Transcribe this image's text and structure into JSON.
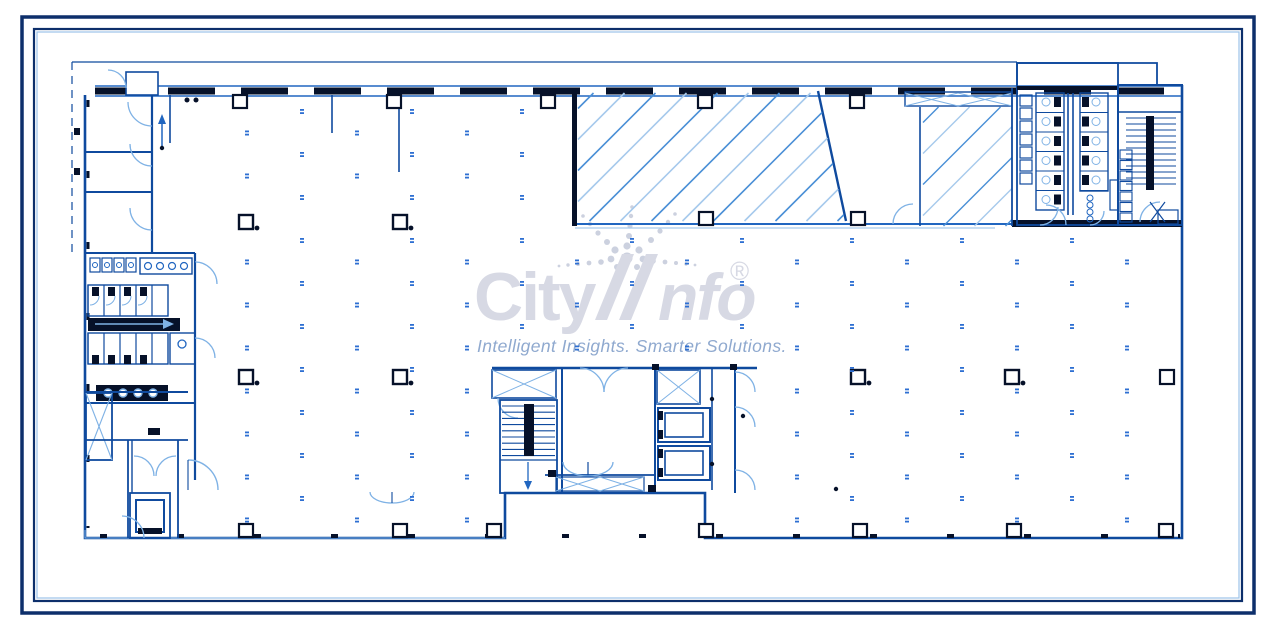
{
  "document": {
    "type": "architectural-floor-plan",
    "description": "CAD floor plan drawing, blue linework on white with double navy border frame"
  },
  "watermark": {
    "brand_prefix": "City",
    "brand_suffix": "nfo",
    "registered_mark": "®",
    "tagline": "Intelligent Insights. Smarter Solutions."
  },
  "icons": {
    "starburst": "dot-starburst-logo-mark",
    "north_arrow": "up-arrow",
    "corridor_arrow": "right-arrow"
  },
  "colors": {
    "background": "#ffffff",
    "frame_navy": "#0d2f6b",
    "frame_accent": "#9cc3e8",
    "wall_dark": "#061129",
    "line_blue": "#0f4a9e",
    "line_blue_bright": "#2166c0",
    "detail_light_blue": "#7fb2e5",
    "hatch_blue": "#4a8fd6",
    "hatch_light_blue": "#a6c9ec",
    "marker_blue": "#2e6fd2",
    "watermark_gray": "#d7d9e4",
    "starburst_gray": "#ccd1df",
    "tagline_blue": "#8fa9cf"
  }
}
